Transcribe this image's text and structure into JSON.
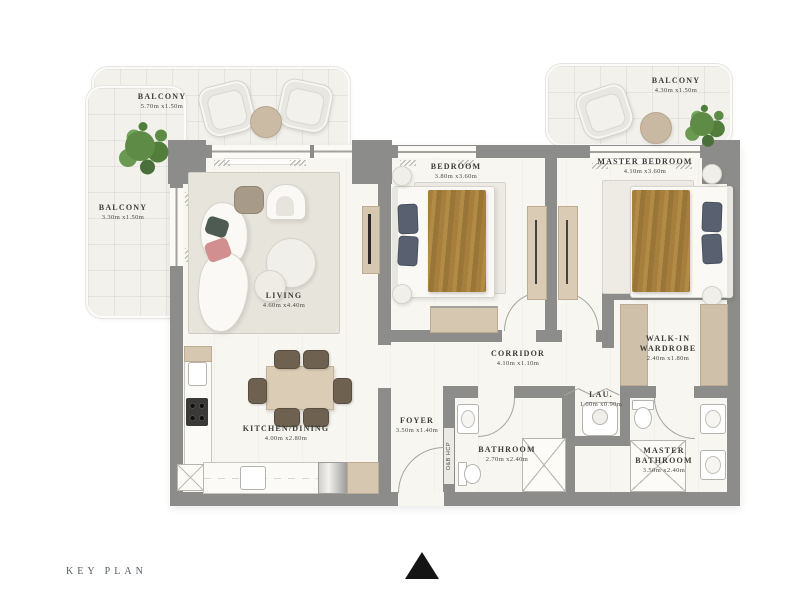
{
  "key_plan_label": "KEY PLAN",
  "wall_label": "D&B HCP",
  "rooms": {
    "balcony_top_left": {
      "name": "BALCONY",
      "dims": "5.70m x1.50m"
    },
    "balcony_left": {
      "name": "BALCONY",
      "dims": "3.30m x1.50m"
    },
    "balcony_top_right": {
      "name": "BALCONY",
      "dims": "4.30m x1.50m"
    },
    "bedroom": {
      "name": "BEDROOM",
      "dims": "3.80m x3.60m"
    },
    "master_bedroom": {
      "name": "MASTER BEDROOM",
      "dims": "4.10m x3.60m"
    },
    "living": {
      "name": "LIVING",
      "dims": "4.60m x4.40m"
    },
    "kitchen_dining": {
      "name": "KITCHEN/DINING",
      "dims": "4.00m x2.80m"
    },
    "corridor": {
      "name": "CORRIDOR",
      "dims": "4.10m x1.10m"
    },
    "foyer": {
      "name": "FOYER",
      "dims": "3.50m x1.40m"
    },
    "bathroom": {
      "name": "BATHROOM",
      "dims": "2.70m x2.40m"
    },
    "laundry": {
      "name": "LAU.",
      "dims": "1.00m x0.90m"
    },
    "walk_in_wardrobe": {
      "name": "WALK-IN WARDROBE",
      "dims": "2.40m x1.80m"
    },
    "master_bathroom": {
      "name": "MASTER BATHROOM",
      "dims": "3.50m x2.40m"
    }
  },
  "colors": {
    "wall": "#8c8c8a",
    "floor": "#f7f6f1",
    "balcony_floor": "#f2f1ec",
    "wood_accent": "#d6c7b0",
    "bed_blanket": "#a67f3e",
    "pillow": "#59606f",
    "plant": "#5e8b46",
    "label_text": "#3e3c38"
  }
}
